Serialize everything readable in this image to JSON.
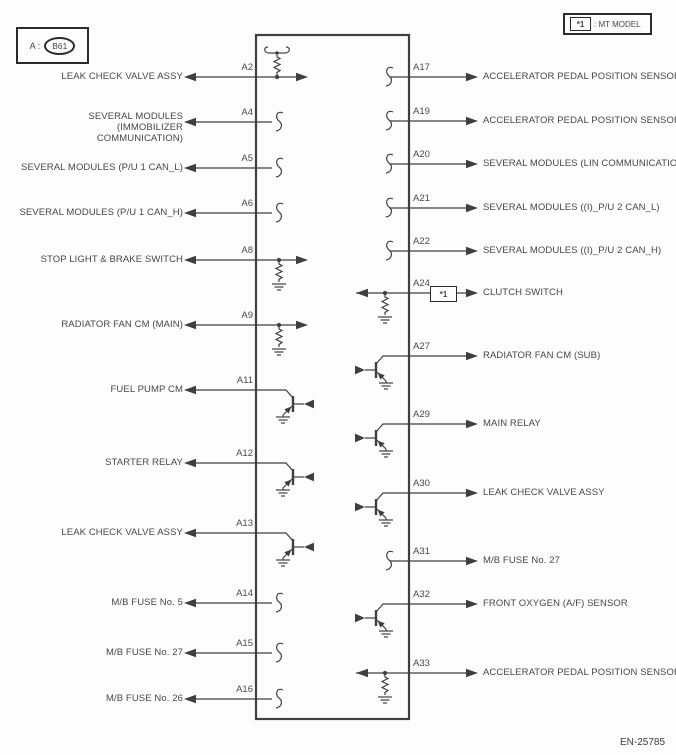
{
  "connector_legend": {
    "prefix": "A :",
    "id": "B61"
  },
  "mt_note": {
    "marker": "*1",
    "text": ": MT MODEL"
  },
  "footer": {
    "code": "EN-25785"
  },
  "colors": {
    "line": "#3f3f3f",
    "text": "#474747",
    "background": "#fdfdfd",
    "box_border": "#2b2b2b"
  },
  "left_pins": [
    {
      "pin": "A2",
      "label": "LEAK CHECK VALVE ASSY",
      "symbol": "resistor-network-top"
    },
    {
      "pin": "A4",
      "label": "SEVERAL MODULES (IMMOBILIZER COMMUNICATION)",
      "symbol": "coil-squiggle"
    },
    {
      "pin": "A5",
      "label": "SEVERAL MODULES (P/U 1 CAN_L)",
      "symbol": "coil-squiggle"
    },
    {
      "pin": "A6",
      "label": "SEVERAL MODULES (P/U 1 CAN_H)",
      "symbol": "coil-squiggle"
    },
    {
      "pin": "A8",
      "label": "STOP LIGHT & BRAKE SWITCH",
      "symbol": "resistor-to-ground-input"
    },
    {
      "pin": "A9",
      "label": "RADIATOR FAN CM (MAIN)",
      "symbol": "resistor-to-ground-input"
    },
    {
      "pin": "A11",
      "label": "FUEL PUMP CM",
      "symbol": "transistor-driver"
    },
    {
      "pin": "A12",
      "label": "STARTER RELAY",
      "symbol": "transistor-driver"
    },
    {
      "pin": "A13",
      "label": "LEAK CHECK VALVE ASSY",
      "symbol": "transistor-driver"
    },
    {
      "pin": "A14",
      "label": "M/B FUSE No. 5",
      "symbol": "coil-squiggle"
    },
    {
      "pin": "A15",
      "label": "M/B FUSE No. 27",
      "symbol": "coil-squiggle"
    },
    {
      "pin": "A16",
      "label": "M/B FUSE No. 26",
      "symbol": "coil-squiggle"
    }
  ],
  "right_pins": [
    {
      "pin": "A17",
      "label": "ACCELERATOR PEDAL POSITION SENSOR",
      "symbol": "coil-squiggle"
    },
    {
      "pin": "A19",
      "label": "ACCELERATOR PEDAL POSITION SENSOR",
      "symbol": "coil-squiggle"
    },
    {
      "pin": "A20",
      "label": "SEVERAL MODULES (LIN COMMUNICATION)",
      "symbol": "coil-squiggle"
    },
    {
      "pin": "A21",
      "label": "SEVERAL MODULES ((I)_P/U 2 CAN_L)",
      "symbol": "coil-squiggle"
    },
    {
      "pin": "A22",
      "label": "SEVERAL MODULES ((I)_P/U 2 CAN_H)",
      "symbol": "coil-squiggle"
    },
    {
      "pin": "A24",
      "label": "CLUTCH SWITCH",
      "symbol": "resistor-to-ground-input",
      "mt_only": true
    },
    {
      "pin": "A27",
      "label": "RADIATOR FAN CM (SUB)",
      "symbol": "transistor-driver"
    },
    {
      "pin": "A29",
      "label": "MAIN RELAY",
      "symbol": "transistor-driver"
    },
    {
      "pin": "A30",
      "label": "LEAK CHECK VALVE ASSY",
      "symbol": "transistor-driver"
    },
    {
      "pin": "A31",
      "label": "M/B FUSE No. 27",
      "symbol": "coil-squiggle"
    },
    {
      "pin": "A32",
      "label": "FRONT OXYGEN (A/F) SENSOR",
      "symbol": "transistor-driver"
    },
    {
      "pin": "A33",
      "label": "ACCELERATOR PEDAL POSITION SENSOR",
      "symbol": "resistor-to-ground-input"
    }
  ]
}
